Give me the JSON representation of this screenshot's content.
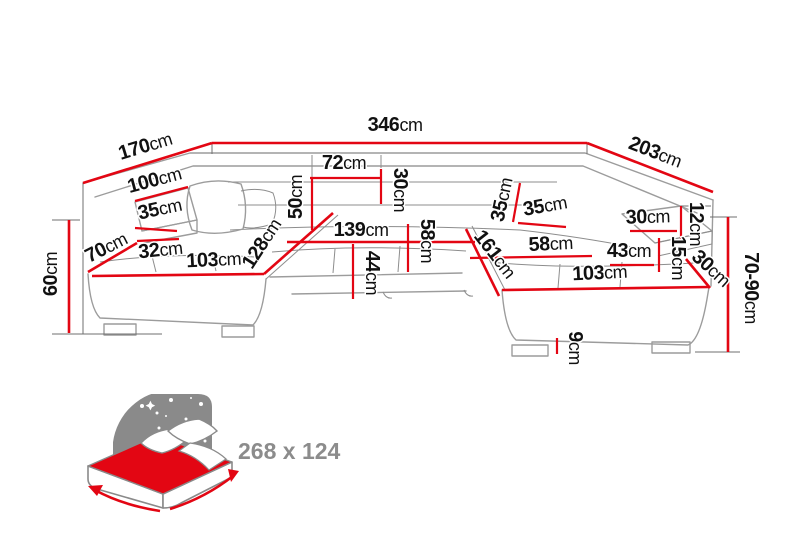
{
  "diagram": {
    "type": "corner-sofa-dimension-diagram",
    "colors": {
      "dimension_red": "#e30613",
      "outline_gray": "#9c9c9c",
      "text_black": "#111111",
      "icon_gray": "#8a8a8a",
      "label_gray": "#8c8c8c"
    },
    "dims": [
      {
        "id": "back-width",
        "num": "346",
        "unit": "cm"
      },
      {
        "id": "left-back-depth",
        "num": "170",
        "unit": "cm"
      },
      {
        "id": "right-back-depth",
        "num": "203",
        "unit": "cm"
      },
      {
        "id": "left-back-height",
        "num": "100",
        "unit": "cm"
      },
      {
        "id": "left-armrest-top",
        "num": "35",
        "unit": "cm"
      },
      {
        "id": "left-front-depth",
        "num": "70",
        "unit": "cm"
      },
      {
        "id": "left-armrest-front",
        "num": "32",
        "unit": "cm"
      },
      {
        "id": "left-seat-length",
        "num": "103",
        "unit": "cm"
      },
      {
        "id": "left-chaise-diagonal",
        "num": "128",
        "unit": "cm"
      },
      {
        "id": "left-side-height",
        "num": "60",
        "unit": "cm"
      },
      {
        "id": "headrest-width",
        "num": "72",
        "unit": "cm"
      },
      {
        "id": "headrest-height",
        "num": "30",
        "unit": "cm"
      },
      {
        "id": "backrest-height",
        "num": "50",
        "unit": "cm"
      },
      {
        "id": "middle-seat-width",
        "num": "139",
        "unit": "cm"
      },
      {
        "id": "seat-depth-middle",
        "num": "58",
        "unit": "cm"
      },
      {
        "id": "seat-height",
        "num": "44",
        "unit": "cm"
      },
      {
        "id": "right-backrest-height",
        "num": "35",
        "unit": "cm"
      },
      {
        "id": "right-armrest-top",
        "num": "35",
        "unit": "cm"
      },
      {
        "id": "right-chaise-diagonal",
        "num": "161",
        "unit": "cm"
      },
      {
        "id": "right-seat-depth",
        "num": "58",
        "unit": "cm"
      },
      {
        "id": "right-armrest-depth",
        "num": "43",
        "unit": "cm"
      },
      {
        "id": "right-armrest-top-len",
        "num": "30",
        "unit": "cm"
      },
      {
        "id": "right-armrest-width",
        "num": "12",
        "unit": "cm"
      },
      {
        "id": "right-armrest-height",
        "num": "15",
        "unit": "cm"
      },
      {
        "id": "right-corner-width",
        "num": "30",
        "unit": "cm"
      },
      {
        "id": "right-seat-length",
        "num": "103",
        "unit": "cm"
      },
      {
        "id": "right-side-height",
        "num": "70-90",
        "unit": "cm"
      },
      {
        "id": "leg-height",
        "num": "9",
        "unit": "cm"
      }
    ],
    "sleeping_area": {
      "label": "268 x 124"
    }
  }
}
